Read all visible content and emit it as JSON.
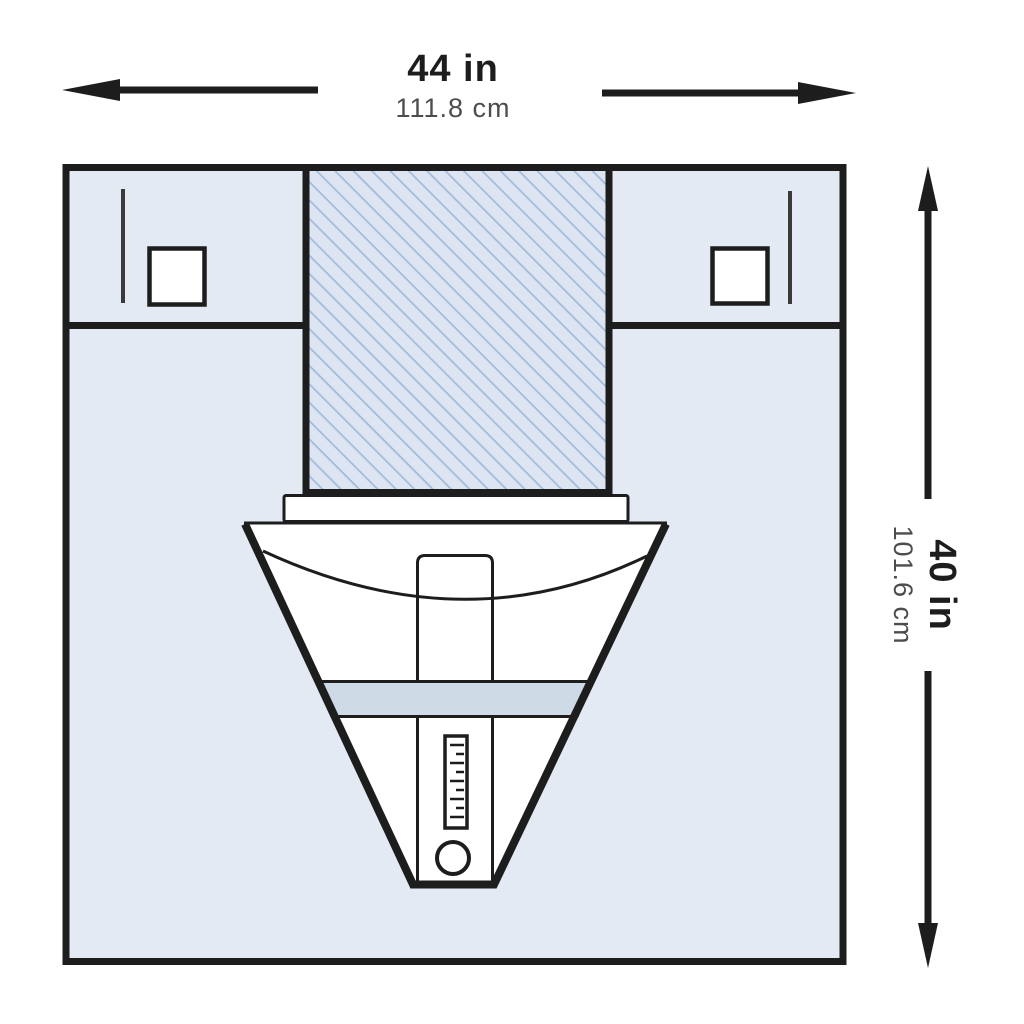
{
  "title": "Surgical drape with fluid collection pouch — dimension diagram",
  "dimensions": {
    "width": {
      "imperial": "44 in",
      "metric": "111.8 cm"
    },
    "height": {
      "imperial": "40 in",
      "metric": "101.6 cm"
    }
  },
  "icons": {
    "arrow-left": "◀",
    "arrow-right": "▶",
    "arrow-up": "▲",
    "arrow-down": "▼"
  },
  "colors": {
    "line": "#1d1d1d",
    "drape-fill": "#e4eaf3",
    "fenestration-fill": "#dce5f1",
    "hatch-line": "#a3bbdb",
    "band-fill": "#cfdae7",
    "metric-text": "#4d4d4d",
    "white": "#ffffff"
  }
}
